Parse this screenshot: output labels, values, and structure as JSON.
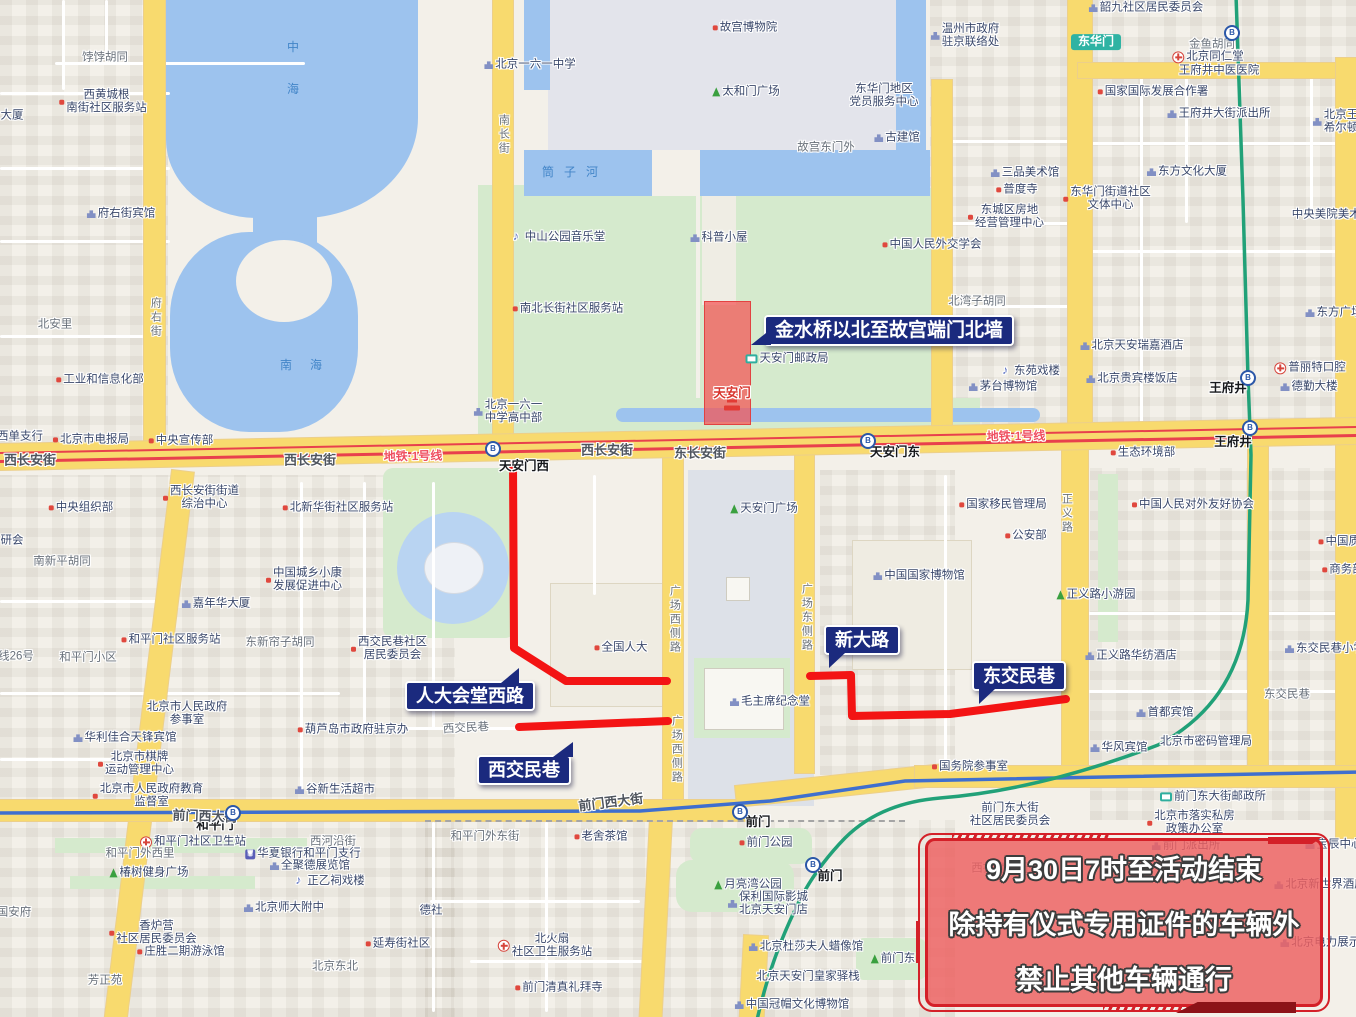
{
  "notice": {
    "lines": [
      "9月30日7时至活动结束",
      "除持有仪式专用证件的车辆外",
      "禁止其他车辆通行"
    ]
  },
  "callouts": [
    {
      "id": "c1",
      "label": "金水桥以北至故宫端门北墙"
    },
    {
      "id": "c2",
      "label": "人大会堂西路"
    },
    {
      "id": "c3",
      "label": "西交民巷"
    },
    {
      "id": "c4",
      "label": "新大路"
    },
    {
      "id": "c5",
      "label": "东交民巷"
    }
  ],
  "colors": {
    "restricted_route": "#f31414",
    "restricted_zone": "#f45353",
    "callout_bg": "#1b2a7e",
    "notice_border": "#d42028",
    "metro_line1": "#e8404d",
    "metro_line2": "#3f6fce",
    "metro_line8": "#21a178",
    "road_major": "#f8da6e",
    "water": "#9dc3ee",
    "park": "#d5eacd"
  },
  "map_labels": [
    {
      "t": "饽饽胡同",
      "x": 105,
      "y": 58,
      "c": "street"
    },
    {
      "t": [
        "西黄城根",
        "南街社区服务站"
      ],
      "x": 103,
      "y": 102,
      "c": "poi",
      "i": "dot"
    },
    {
      "t": "大厦",
      "x": 12,
      "y": 116,
      "c": "poi"
    },
    {
      "t": "府右街宾馆",
      "x": 121,
      "y": 214,
      "c": "poi",
      "i": "bld"
    },
    {
      "t": "北安里",
      "x": 55,
      "y": 325,
      "c": "street"
    },
    {
      "t": "工业和信息化部",
      "x": 100,
      "y": 380,
      "c": "poi",
      "i": "dot"
    },
    {
      "t": "西单支行",
      "x": 20,
      "y": 437,
      "c": "poi"
    },
    {
      "t": "北京市电报局",
      "x": 91,
      "y": 440,
      "c": "poi",
      "i": "dot"
    },
    {
      "t": "中央宣传部",
      "x": 181,
      "y": 441,
      "c": "poi",
      "i": "dot"
    },
    {
      "t": "中央组织部",
      "x": 81,
      "y": 508,
      "c": "poi",
      "i": "dot"
    },
    {
      "t": [
        "西长安街街道",
        "综治中心"
      ],
      "x": 201,
      "y": 498,
      "c": "poi",
      "i": "dot"
    },
    {
      "t": "北新华街社区服务站",
      "x": 338,
      "y": 508,
      "c": "poi",
      "i": "dot"
    },
    {
      "t": "南新平胡同",
      "x": 62,
      "y": 562,
      "c": "street"
    },
    {
      "t": [
        "中国城乡小康",
        "发展促进中心"
      ],
      "x": 304,
      "y": 580,
      "c": "poi",
      "i": "dot"
    },
    {
      "t": "嘉年华大厦",
      "x": 216,
      "y": 604,
      "c": "poi",
      "i": "bld"
    },
    {
      "t": "和平门社区服务站",
      "x": 171,
      "y": 640,
      "c": "poi",
      "i": "dot"
    },
    {
      "t": "和平门小区",
      "x": 88,
      "y": 658,
      "c": "street"
    },
    {
      "t": "东新帘子胡同",
      "x": 280,
      "y": 643,
      "c": "street"
    },
    {
      "t": [
        "西交民巷社区",
        "居民委员会"
      ],
      "x": 389,
      "y": 649,
      "c": "poi",
      "i": "dot"
    },
    {
      "t": "研会",
      "x": 12,
      "y": 541,
      "c": "poi"
    },
    {
      "t": [
        "北京市人民政府",
        "参事室"
      ],
      "x": 187,
      "y": 714,
      "c": "poi"
    },
    {
      "t": "葫芦岛市政府驻京办",
      "x": 353,
      "y": 730,
      "c": "poi",
      "i": "dot"
    },
    {
      "t": "谷新生活超市",
      "x": 335,
      "y": 790,
      "c": "poi",
      "i": "bld"
    },
    {
      "t": "华利佳合天锋宾馆",
      "x": 125,
      "y": 738,
      "c": "poi",
      "i": "bld"
    },
    {
      "t": [
        "北京市棋牌",
        "运动管理中心"
      ],
      "x": 136,
      "y": 764,
      "c": "poi",
      "i": "dot"
    },
    {
      "t": [
        "北京市人民政府教育",
        "监督室"
      ],
      "x": 148,
      "y": 796,
      "c": "poi",
      "i": "dot"
    },
    {
      "t": "线26号",
      "x": 16,
      "y": 657,
      "c": "street"
    },
    {
      "t": "中",
      "x": 293,
      "y": 48,
      "c": "wtr"
    },
    {
      "t": "海",
      "x": 293,
      "y": 90,
      "c": "wtr"
    },
    {
      "t": "南海",
      "x": 310,
      "y": 366,
      "c": "wtr",
      "ls": 18
    },
    {
      "t": "筒子河",
      "x": 575,
      "y": 173,
      "c": "wtr",
      "ls": 10
    },
    {
      "t": "北京一六一中学",
      "x": 530,
      "y": 65,
      "c": "poi",
      "i": "bld"
    },
    {
      "t": "故宫博物院",
      "x": 745,
      "y": 28,
      "c": "poi",
      "i": "dot"
    },
    {
      "t": "太和门广场",
      "x": 746,
      "y": 92,
      "c": "poi",
      "i": "tree"
    },
    {
      "t": "故宫东门外",
      "x": 826,
      "y": 148,
      "c": "street"
    },
    {
      "t": "古建馆",
      "x": 897,
      "y": 138,
      "c": "poi",
      "i": "bld"
    },
    {
      "t": [
        "温州市政府",
        "驻京联络处"
      ],
      "x": 965,
      "y": 36,
      "c": "poi",
      "i": "bld"
    },
    {
      "t": [
        "东华门地区",
        "党员服务中心"
      ],
      "x": 884,
      "y": 96,
      "c": "poi"
    },
    {
      "t": "韶九社区居民委员会",
      "x": 1146,
      "y": 8,
      "c": "poi",
      "i": "bld"
    },
    {
      "t": "金鱼胡同",
      "x": 1212,
      "y": 45,
      "c": "street"
    },
    {
      "t": "北京同仁堂",
      "x": 1208,
      "y": 57,
      "c": "poi",
      "i": "hosp"
    },
    {
      "t": "王府井中医医院",
      "x": 1219,
      "y": 71,
      "c": "poi"
    },
    {
      "t": "国家国际发展合作署",
      "x": 1153,
      "y": 92,
      "c": "poi",
      "i": "dot"
    },
    {
      "t": "王府井大街派出所",
      "x": 1219,
      "y": 114,
      "c": "poi",
      "i": "bld"
    },
    {
      "t": [
        "北京王府井",
        "希尔顿酒店"
      ],
      "x": 1347,
      "y": 122,
      "c": "poi",
      "i": "bld"
    },
    {
      "t": "东方文化大厦",
      "x": 1187,
      "y": 172,
      "c": "poi",
      "i": "bld"
    },
    {
      "t": "三品美术馆",
      "x": 1025,
      "y": 173,
      "c": "poi",
      "i": "bld"
    },
    {
      "t": "普度寺",
      "x": 1017,
      "y": 190,
      "c": "poi",
      "i": "dot"
    },
    {
      "t": [
        "东城区房地",
        "经营管理中心"
      ],
      "x": 1006,
      "y": 217,
      "c": "poi",
      "i": "dot"
    },
    {
      "t": [
        "东华门街道社区",
        "文体中心"
      ],
      "x": 1107,
      "y": 199,
      "c": "poi",
      "i": "dot"
    },
    {
      "t": "中央美院美术馆",
      "x": 1332,
      "y": 215,
      "c": "poi"
    },
    {
      "t": "东方广场",
      "x": 1334,
      "y": 313,
      "c": "poi",
      "i": "bld"
    },
    {
      "t": "中山公园音乐堂",
      "x": 559,
      "y": 237,
      "c": "poi",
      "i": "music"
    },
    {
      "t": "科普小屋",
      "x": 719,
      "y": 238,
      "c": "poi",
      "i": "bld"
    },
    {
      "t": "中国人民外交学会",
      "x": 932,
      "y": 245,
      "c": "poi",
      "i": "dot"
    },
    {
      "t": "南北长街社区服务站",
      "x": 568,
      "y": 309,
      "c": "poi",
      "i": "dot"
    },
    {
      "t": "北湾子胡同",
      "x": 977,
      "y": 302,
      "c": "street"
    },
    {
      "t": "东苑戏楼",
      "x": 1031,
      "y": 371,
      "c": "poi",
      "i": "music"
    },
    {
      "t": "茅台博物馆",
      "x": 1003,
      "y": 387,
      "c": "poi",
      "i": "bld"
    },
    {
      "t": "天安门邮政局",
      "x": 787,
      "y": 359,
      "c": "poi",
      "i": "post"
    },
    {
      "t": "北京天安瑞嘉酒店",
      "x": 1132,
      "y": 346,
      "c": "poi",
      "i": "bld"
    },
    {
      "t": "北京贵宾楼饭店",
      "x": 1132,
      "y": 379,
      "c": "poi",
      "i": "bld"
    },
    {
      "t": "普丽特口腔",
      "x": 1310,
      "y": 368,
      "c": "poi",
      "i": "hosp"
    },
    {
      "t": "德勤大楼",
      "x": 1309,
      "y": 387,
      "c": "poi",
      "i": "bld"
    },
    {
      "t": "天安门",
      "x": 732,
      "y": 393,
      "c": "redplace"
    },
    {
      "t": [
        "北京一六一",
        "中学高中部"
      ],
      "x": 508,
      "y": 412,
      "c": "poi",
      "i": "bld"
    },
    {
      "t": "生态环境部",
      "x": 1143,
      "y": 453,
      "c": "poi",
      "i": "dot"
    },
    {
      "t": "西长安街",
      "x": 30,
      "y": 461,
      "c": "road"
    },
    {
      "t": "西长安街",
      "x": 310,
      "y": 461,
      "c": "road"
    },
    {
      "t": "西长安街",
      "x": 607,
      "y": 451,
      "c": "road"
    },
    {
      "t": "东长安街",
      "x": 700,
      "y": 454,
      "c": "road"
    },
    {
      "t": "地铁·1号线",
      "x": 413,
      "y": 457,
      "c": "metro1",
      "r": -1
    },
    {
      "t": "地铁·1号线",
      "x": 1016,
      "y": 437,
      "c": "metro1",
      "r": -1
    },
    {
      "t": "天安门西",
      "x": 524,
      "y": 466,
      "c": "station"
    },
    {
      "t": "天安门东",
      "x": 895,
      "y": 452,
      "c": "station"
    },
    {
      "t": "王府井",
      "x": 1228,
      "y": 388,
      "c": "station"
    },
    {
      "t": "王府井",
      "x": 1233,
      "y": 442,
      "c": "station"
    },
    {
      "t": "东华门",
      "x": 1096,
      "y": 42,
      "c": "tstation"
    },
    {
      "t": "天安门广场",
      "x": 764,
      "y": 509,
      "c": "poi",
      "i": "tree"
    },
    {
      "t": "国家移民管理局",
      "x": 1003,
      "y": 505,
      "c": "poi",
      "i": "dot"
    },
    {
      "t": "公安部",
      "x": 1026,
      "y": 536,
      "c": "poi",
      "i": "dot"
    },
    {
      "t": "中国国家博物馆",
      "x": 919,
      "y": 576,
      "c": "poi",
      "i": "bld"
    },
    {
      "t": "正义路小游园",
      "x": 1096,
      "y": 595,
      "c": "poi",
      "i": "tree"
    },
    {
      "t": "中国人民对外友好协会",
      "x": 1193,
      "y": 505,
      "c": "poi",
      "i": "dot"
    },
    {
      "t": "中国质量",
      "x": 1345,
      "y": 542,
      "c": "poi",
      "i": "dot"
    },
    {
      "t": "商务部",
      "x": 1343,
      "y": 570,
      "c": "poi",
      "i": "dot"
    },
    {
      "t": "全国人大",
      "x": 621,
      "y": 648,
      "c": "poi",
      "i": "dot"
    },
    {
      "t": "毛主席纪念堂",
      "x": 770,
      "y": 702,
      "c": "poi",
      "i": "bld"
    },
    {
      "t": "正义路华纺酒店",
      "x": 1131,
      "y": 656,
      "c": "poi",
      "i": "bld"
    },
    {
      "t": "东交民巷小学",
      "x": 1325,
      "y": 649,
      "c": "poi",
      "i": "bld"
    },
    {
      "t": "东交民巷",
      "x": 1287,
      "y": 695,
      "c": "street"
    },
    {
      "t": "首都宾馆",
      "x": 1165,
      "y": 713,
      "c": "poi",
      "i": "bld"
    },
    {
      "t": "华风宾馆",
      "x": 1119,
      "y": 748,
      "c": "poi",
      "i": "bld"
    },
    {
      "t": "北京市密码管理局",
      "x": 1206,
      "y": 742,
      "c": "poi"
    },
    {
      "t": "国务院参事室",
      "x": 970,
      "y": 767,
      "c": "poi",
      "i": "dot"
    },
    {
      "t": "西交民巷",
      "x": 466,
      "y": 729,
      "c": "street",
      "r": -3
    },
    {
      "t": "和平门",
      "x": 215,
      "y": 825,
      "c": "station"
    },
    {
      "t": "和平门社区卫生站",
      "x": 193,
      "y": 842,
      "c": "poi",
      "i": "hosp"
    },
    {
      "t": "和平门外西里",
      "x": 140,
      "y": 854,
      "c": "street"
    },
    {
      "t": "椿树健身广场",
      "x": 149,
      "y": 873,
      "c": "poi",
      "i": "tree"
    },
    {
      "t": [
        "香炉营",
        "社区居民委员会"
      ],
      "x": 153,
      "y": 933,
      "c": "poi",
      "i": "dot"
    },
    {
      "t": "庄胜二期游泳馆",
      "x": 181,
      "y": 952,
      "c": "poi",
      "i": "dot"
    },
    {
      "t": "芳正苑",
      "x": 105,
      "y": 981,
      "c": "street"
    },
    {
      "t": "国安府",
      "x": 14,
      "y": 913,
      "c": "street"
    },
    {
      "t": "北京师大附中",
      "x": 284,
      "y": 908,
      "c": "poi",
      "i": "bld"
    },
    {
      "t": "北京东北",
      "x": 335,
      "y": 967,
      "c": "street"
    },
    {
      "t": "延寿街社区",
      "x": 398,
      "y": 944,
      "c": "poi",
      "i": "dot"
    },
    {
      "t": "德社",
      "x": 431,
      "y": 911,
      "c": "poi"
    },
    {
      "t": "西河沿街",
      "x": 333,
      "y": 842,
      "c": "street"
    },
    {
      "t": "华夏银行和平门支行",
      "x": 303,
      "y": 854,
      "c": "poi",
      "i": "bank"
    },
    {
      "t": "全聚德展览馆",
      "x": 310,
      "y": 866,
      "c": "poi",
      "i": "bld"
    },
    {
      "t": "正乙祠戏楼",
      "x": 330,
      "y": 881,
      "c": "poi",
      "i": "music"
    },
    {
      "t": "和平门外东街",
      "x": 485,
      "y": 837,
      "c": "street"
    },
    {
      "t": "老舍茶馆",
      "x": 601,
      "y": 837,
      "c": "poi",
      "i": "dot"
    },
    {
      "t": "前门西大街",
      "x": 205,
      "y": 817,
      "c": "road",
      "r": 2
    },
    {
      "t": "前门西大街",
      "x": 611,
      "y": 803,
      "c": "road",
      "r": -7
    },
    {
      "t": "前门",
      "x": 758,
      "y": 822,
      "c": "station"
    },
    {
      "t": "前门公园",
      "x": 766,
      "y": 843,
      "c": "poi",
      "i": "dot"
    },
    {
      "t": "月亮湾公园",
      "x": 748,
      "y": 885,
      "c": "poi",
      "i": "tree"
    },
    {
      "t": [
        "保利国际影城",
        "北京天安门店"
      ],
      "x": 768,
      "y": 904,
      "c": "poi",
      "i": "bld"
    },
    {
      "t": "前门",
      "x": 830,
      "y": 876,
      "c": "station"
    },
    {
      "t": "北京杜莎夫人蜡像馆",
      "x": 806,
      "y": 947,
      "c": "poi",
      "i": "bld"
    },
    {
      "t": "前门东",
      "x": 893,
      "y": 959,
      "c": "poi",
      "i": "tree"
    },
    {
      "t": "北京天安门皇家驿栈",
      "x": 808,
      "y": 977,
      "c": "poi"
    },
    {
      "t": "中国冠帽文化博物馆",
      "x": 792,
      "y": 1005,
      "c": "poi",
      "i": "bld"
    },
    {
      "t": [
        "北火扇",
        "社区卫生服务站"
      ],
      "x": 545,
      "y": 946,
      "c": "poi",
      "i": "hosp"
    },
    {
      "t": "前门清真礼拜寺",
      "x": 559,
      "y": 988,
      "c": "poi",
      "i": "dot"
    },
    {
      "t": [
        "前门东大街",
        "社区居民委员会"
      ],
      "x": 1010,
      "y": 815,
      "c": "poi"
    },
    {
      "t": "前门东大街邮政所",
      "x": 1213,
      "y": 797,
      "c": "poi",
      "i": "post"
    },
    {
      "t": [
        "北京市落实私房",
        "政策办公室"
      ],
      "x": 1191,
      "y": 823,
      "c": "poi",
      "i": "dot"
    },
    {
      "t": "前门派出所",
      "x": 1186,
      "y": 846,
      "c": "poi",
      "i": "bld"
    },
    {
      "t": "西打磨厂街",
      "x": 1000,
      "y": 869,
      "c": "street"
    },
    {
      "t": "宝辰中心",
      "x": 1334,
      "y": 845,
      "c": "poi",
      "i": "bld"
    },
    {
      "t": "北京新世界酒店",
      "x": 1320,
      "y": 885,
      "c": "poi",
      "i": "bld"
    },
    {
      "t": "北京电力展示厅",
      "x": 1326,
      "y": 943,
      "c": "poi",
      "i": "bld"
    },
    {
      "c": "icon",
      "i": "metro",
      "x": 493,
      "y": 449
    },
    {
      "c": "icon",
      "i": "metro",
      "x": 868,
      "y": 441
    },
    {
      "c": "icon",
      "i": "metro",
      "x": 1248,
      "y": 378
    },
    {
      "c": "icon",
      "i": "metro",
      "x": 1250,
      "y": 428
    },
    {
      "c": "icon",
      "i": "metro",
      "x": 1232,
      "y": 33
    },
    {
      "c": "icon",
      "i": "metro",
      "x": 233,
      "y": 813
    },
    {
      "c": "icon",
      "i": "metro",
      "x": 740,
      "y": 812
    },
    {
      "c": "icon",
      "i": "metro",
      "x": 813,
      "y": 865
    },
    {
      "c": "icon",
      "i": "gate",
      "x": 732,
      "y": 405
    },
    {
      "t": "府右街",
      "x": 155,
      "y": 318,
      "c": "vstreet"
    },
    {
      "t": "南长街",
      "x": 503,
      "y": 135,
      "c": "vstreet"
    },
    {
      "t": "广场西侧路",
      "x": 674,
      "y": 620,
      "c": "vstreet"
    },
    {
      "t": "广场西侧路",
      "x": 676,
      "y": 750,
      "c": "vstreet"
    },
    {
      "t": "广场东侧路",
      "x": 806,
      "y": 618,
      "c": "vstreet"
    },
    {
      "t": "正义路",
      "x": 1066,
      "y": 514,
      "c": "vstreet"
    }
  ]
}
